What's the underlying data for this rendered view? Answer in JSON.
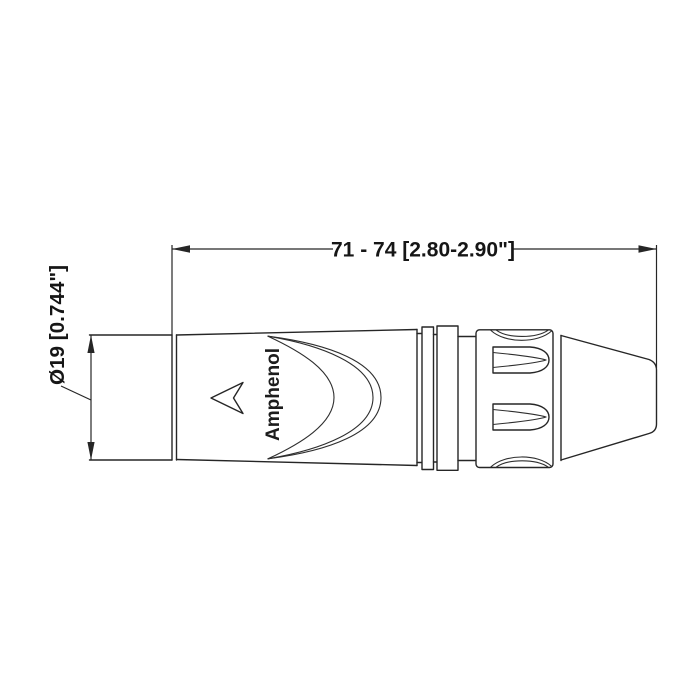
{
  "canvas": {
    "background": "#ffffff",
    "line_color": "#262626",
    "text_color": "#161616"
  },
  "drawing": {
    "brand_label": "Amphenol",
    "length_dimension_label": "71 - 74 [2.80-2.90\"]",
    "diameter_dimension_label": "Ø19 [0.744\"]",
    "logo_icon": "amphenol-arrow-icon"
  }
}
